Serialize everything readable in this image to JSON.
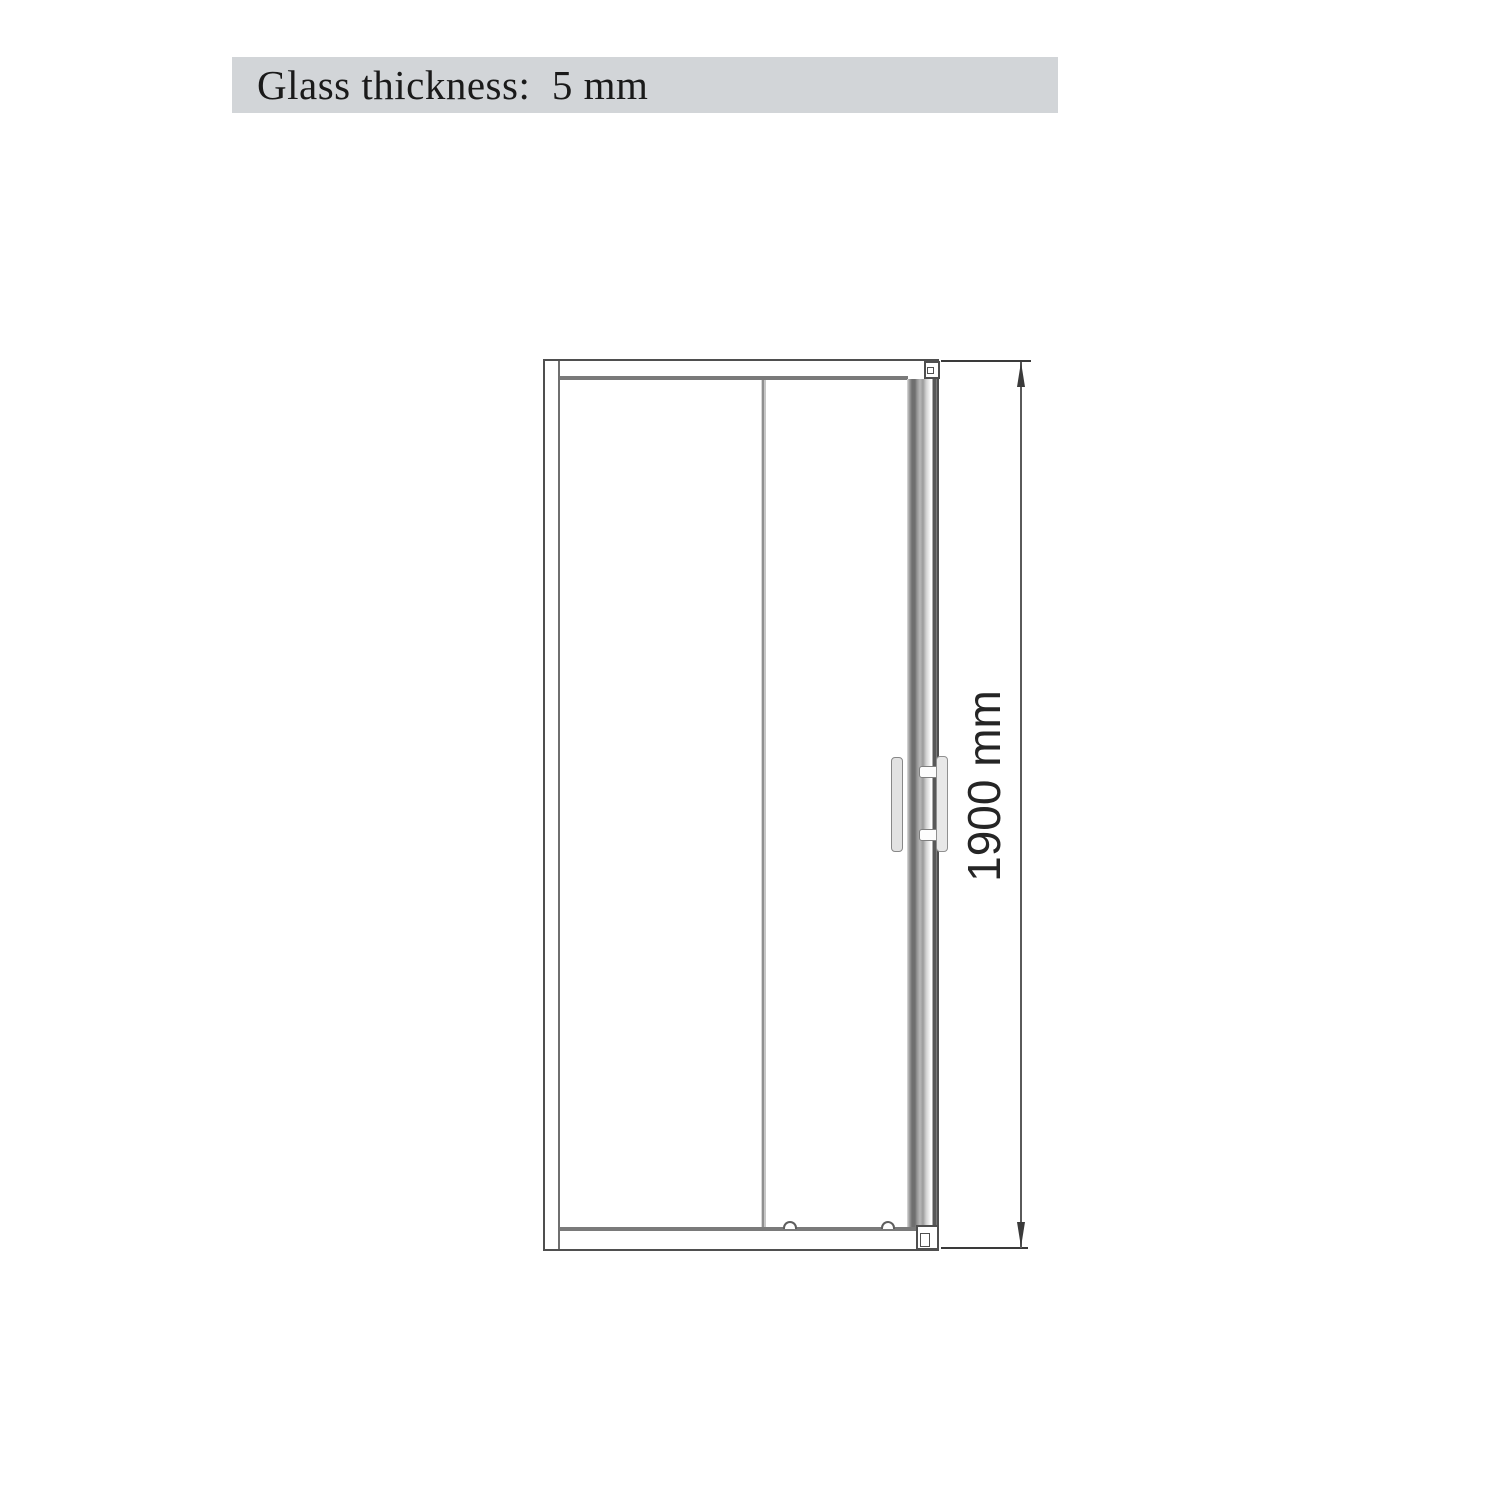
{
  "header": {
    "label": "Glass thickness:  5 mm",
    "background": "#d2d5d8",
    "text_color": "#1a1a1a"
  },
  "drawing": {
    "type": "technical_elevation",
    "subject": "sliding shower door front view",
    "height_label": "1900 mm",
    "height_value_mm": 1900,
    "glass_thickness_mm": 5,
    "colors": {
      "frame_outline": "#4f4f4f",
      "rail_line": "#7a7a7a",
      "divider_line": "#9a9a9a",
      "dimension_ink": "#3a3a3a",
      "handle_fill": "#e2e2e2"
    }
  }
}
